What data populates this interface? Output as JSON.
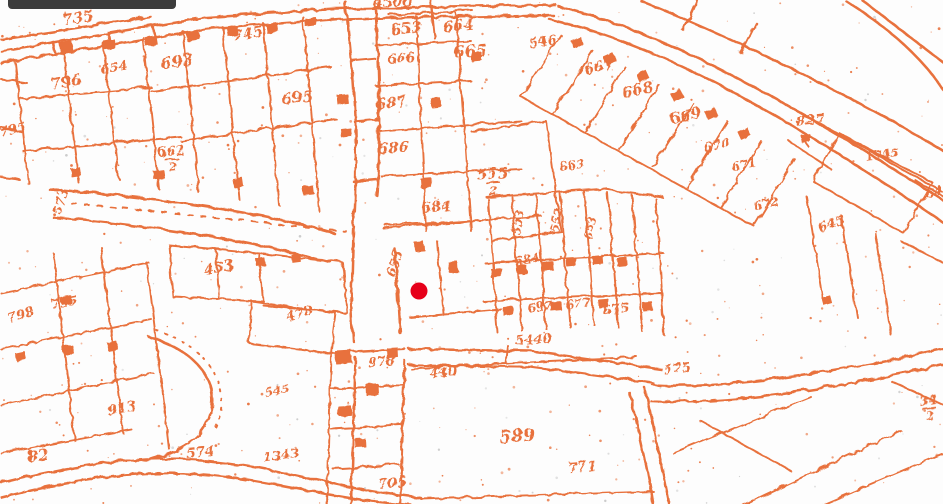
{
  "map": {
    "kind": "historical-cadastral-map-scan",
    "background_color": "#fdfdfd",
    "ink_color": "#e8713c",
    "noise_color": "#c9c9c9",
    "toolbar_fragment": {
      "color": "#3c3c3c"
    },
    "marker": {
      "color": "#e6001a",
      "x": 419,
      "y": 291,
      "radius": 8.5
    },
    "labels": [
      {
        "text": "735",
        "x": 78,
        "y": 22,
        "rot": -8,
        "size": 15
      },
      {
        "text": "745",
        "x": 248,
        "y": 38,
        "rot": -10,
        "size": 15
      },
      {
        "text": "693",
        "x": 177,
        "y": 66,
        "rot": -8,
        "size": 16
      },
      {
        "text": "654",
        "x": 114,
        "y": 71,
        "rot": -10,
        "size": 13
      },
      {
        "text": "796",
        "x": 66,
        "y": 86,
        "rot": -8,
        "size": 15
      },
      {
        "text": "795",
        "x": 13,
        "y": 133,
        "rot": -12,
        "size": 13
      },
      {
        "text": "695",
        "x": 297,
        "y": 102,
        "rot": -6,
        "size": 15
      },
      {
        "text": "4500",
        "x": 392,
        "y": 6,
        "rot": -3,
        "size": 14
      },
      {
        "text": "653",
        "x": 406,
        "y": 33,
        "rot": -5,
        "size": 15
      },
      {
        "text": "664",
        "x": 458,
        "y": 30,
        "rot": -5,
        "size": 15
      },
      {
        "text": "665",
        "x": 470,
        "y": 56,
        "rot": -4,
        "size": 16
      },
      {
        "text": "666",
        "x": 401,
        "y": 62,
        "rot": -5,
        "size": 13
      },
      {
        "text": "546",
        "x": 543,
        "y": 45,
        "rot": -10,
        "size": 13
      },
      {
        "text": "667",
        "x": 599,
        "y": 71,
        "rot": -12,
        "size": 14
      },
      {
        "text": "668",
        "x": 638,
        "y": 94,
        "rot": -14,
        "size": 15
      },
      {
        "text": "669",
        "x": 686,
        "y": 120,
        "rot": -12,
        "size": 15
      },
      {
        "text": "670",
        "x": 717,
        "y": 149,
        "rot": -12,
        "size": 13
      },
      {
        "text": "671",
        "x": 744,
        "y": 168,
        "rot": -12,
        "size": 12
      },
      {
        "text": "672",
        "x": 766,
        "y": 207,
        "rot": -12,
        "size": 12
      },
      {
        "text": "663",
        "x": 572,
        "y": 169,
        "rot": -10,
        "size": 12
      },
      {
        "text": "687",
        "x": 391,
        "y": 107,
        "rot": -6,
        "size": 15
      },
      {
        "text": "686",
        "x": 393,
        "y": 152,
        "rot": -4,
        "size": 15
      },
      {
        "text": "684",
        "x": 436,
        "y": 211,
        "rot": -4,
        "size": 14
      },
      {
        "text": "555",
        "sub": "2",
        "x": 492,
        "y": 178,
        "rot": -3,
        "size": 15
      },
      {
        "text": "662",
        "sub": "2",
        "x": 171,
        "y": 155,
        "rot": -5,
        "size": 13
      },
      {
        "text": "827",
        "x": 810,
        "y": 124,
        "rot": -6,
        "size": 14
      },
      {
        "text": "1745",
        "x": 882,
        "y": 158,
        "rot": -8,
        "size": 12
      },
      {
        "text": "645",
        "x": 832,
        "y": 227,
        "rot": -20,
        "size": 13
      },
      {
        "text": "64",
        "x": 934,
        "y": 196,
        "rot": -10,
        "size": 13
      },
      {
        "text": "453",
        "x": 219,
        "y": 272,
        "rot": -10,
        "size": 15
      },
      {
        "text": "478",
        "x": 300,
        "y": 317,
        "rot": -16,
        "size": 13
      },
      {
        "text": "573",
        "x": 64,
        "y": 202,
        "rot": -75,
        "size": 13
      },
      {
        "text": "655",
        "x": 398,
        "y": 264,
        "rot": -72,
        "size": 13
      },
      {
        "text": "553",
        "x": 521,
        "y": 222,
        "rot": -80,
        "size": 12
      },
      {
        "text": "552",
        "x": 560,
        "y": 220,
        "rot": -80,
        "size": 12
      },
      {
        "text": "653",
        "x": 593,
        "y": 228,
        "rot": -78,
        "size": 11
      },
      {
        "text": "584",
        "x": 527,
        "y": 263,
        "rot": -8,
        "size": 12
      },
      {
        "text": "697",
        "x": 540,
        "y": 310,
        "rot": -8,
        "size": 12
      },
      {
        "text": "677",
        "x": 578,
        "y": 307,
        "rot": -8,
        "size": 12
      },
      {
        "text": "675",
        "x": 616,
        "y": 313,
        "rot": -8,
        "size": 13
      },
      {
        "text": "575",
        "x": 677,
        "y": 372,
        "rot": -8,
        "size": 13
      },
      {
        "text": "5440",
        "x": 533,
        "y": 343,
        "rot": -4,
        "size": 13
      },
      {
        "text": "545",
        "x": 277,
        "y": 394,
        "rot": -10,
        "size": 12
      },
      {
        "text": "798",
        "x": 21,
        "y": 318,
        "rot": -16,
        "size": 13
      },
      {
        "text": "795",
        "x": 64,
        "y": 306,
        "rot": -10,
        "size": 13
      },
      {
        "text": "913",
        "x": 122,
        "y": 412,
        "rot": -10,
        "size": 14
      },
      {
        "text": "82",
        "x": 38,
        "y": 460,
        "rot": -8,
        "size": 15
      },
      {
        "text": "574",
        "x": 200,
        "y": 456,
        "rot": -5,
        "size": 14
      },
      {
        "text": "1343",
        "x": 281,
        "y": 459,
        "rot": -8,
        "size": 13
      },
      {
        "text": "978",
        "x": 381,
        "y": 365,
        "rot": -5,
        "size": 13
      },
      {
        "text": "440",
        "x": 443,
        "y": 376,
        "rot": -5,
        "size": 13
      },
      {
        "text": "705",
        "x": 392,
        "y": 487,
        "rot": -5,
        "size": 14
      },
      {
        "text": "589",
        "x": 517,
        "y": 441,
        "rot": -5,
        "size": 17
      },
      {
        "text": "771",
        "x": 582,
        "y": 471,
        "rot": -5,
        "size": 14
      },
      {
        "text": "34",
        "sub": "2",
        "x": 928,
        "y": 404,
        "rot": -8,
        "size": 13
      }
    ]
  }
}
